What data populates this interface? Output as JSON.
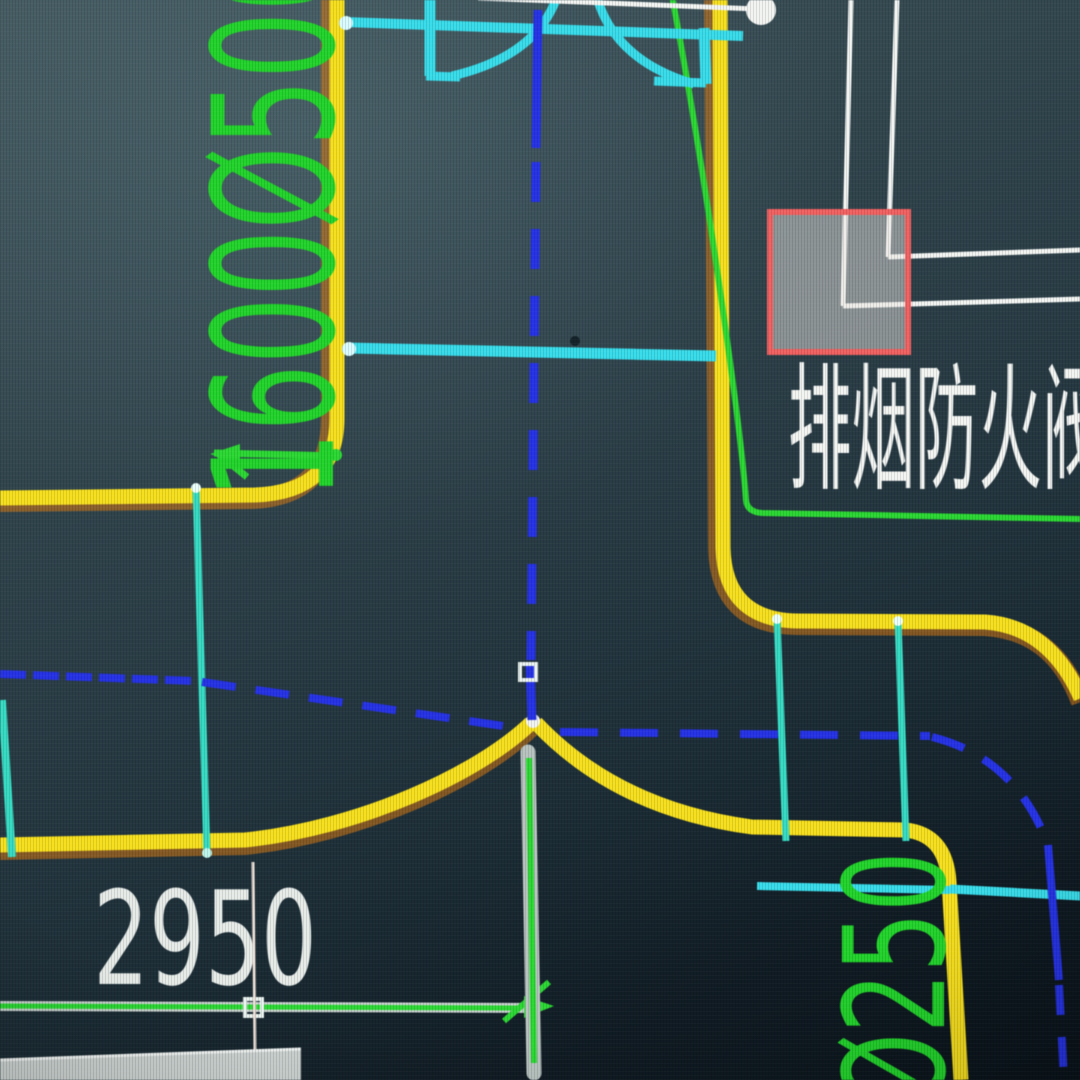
{
  "view": {
    "description": "CAD HVAC duct drawing viewport (photo of screen)",
    "labels": {
      "duct_size_left": "1600Ø500",
      "damper_label": "排烟防火阀",
      "dimension_value": "2950",
      "duct_size_right": "Ø250"
    },
    "colors": {
      "yellow": "#f6df1f",
      "yellow_glow": "#d97a12",
      "green_text": "#23d42c",
      "green_line": "#2cd934",
      "cyan": "#39dcea",
      "branch": "#37dbc3",
      "blue": "#2633e6",
      "white": "#f2f4f2",
      "dim_gray": "#c7d0cd",
      "dim_text": "#e6ebe8",
      "red_box": "#f26262",
      "red_box_fill": "rgba(233,229,225,0.50)",
      "gray_bar": "#b8c3c0",
      "gray_slab": "#ccd3d1",
      "grip": "#e9f2ef"
    }
  }
}
